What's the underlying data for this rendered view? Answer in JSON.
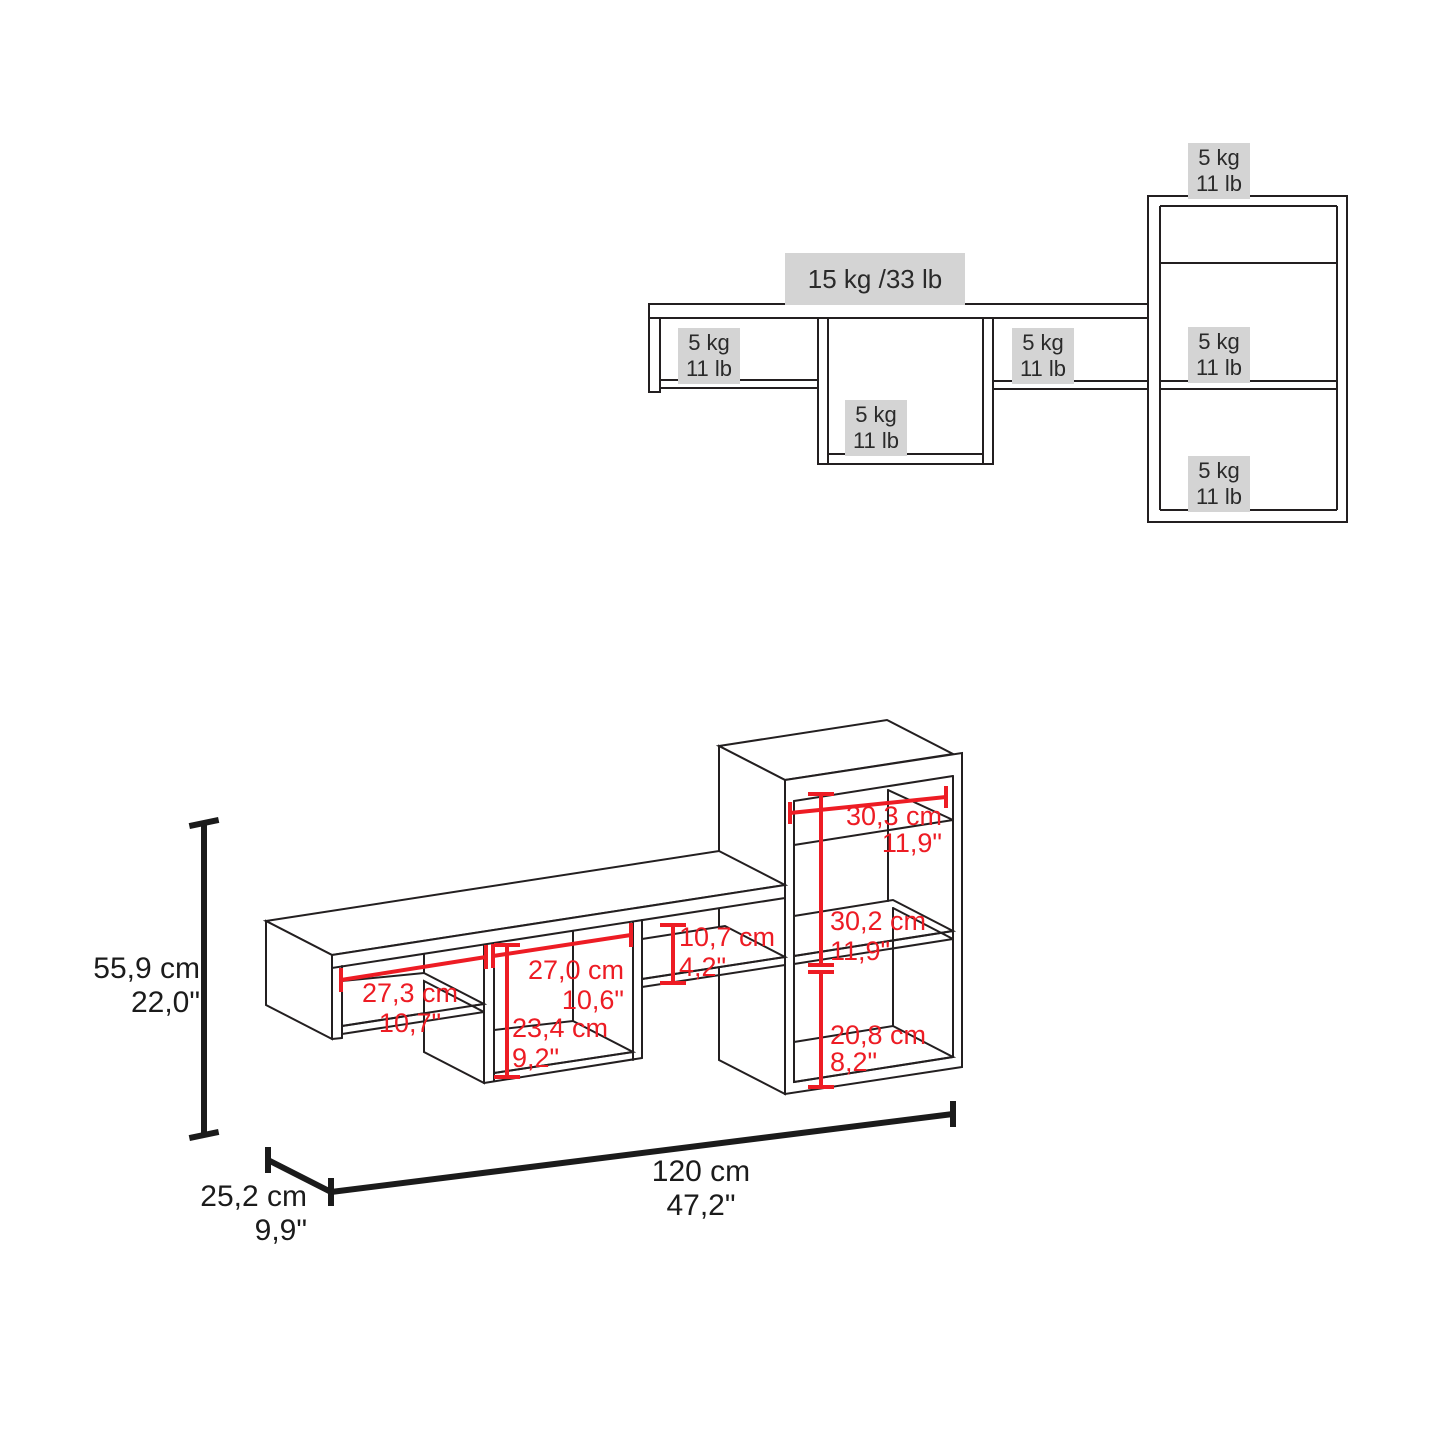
{
  "colors": {
    "line": "#231f20",
    "red": "#ed1c24",
    "black_dim": "#1b1b1b",
    "label_bg": "#d4d4d4"
  },
  "front_view": {
    "main_capacity": "15 kg /33 lb",
    "unit_kg": "5 kg",
    "unit_lb": "11 lb"
  },
  "iso": {
    "height_cm": "55,9 cm",
    "height_in": "22,0\"",
    "depth_cm": "25,2 cm",
    "depth_in": "9,9\"",
    "width_cm": "120 cm",
    "width_in": "47,2\"",
    "left_opening_cm": "27,3 cm",
    "left_opening_in": "10,7\"",
    "center_opening_cm": "27,0 cm",
    "center_opening_in": "10,6\"",
    "center_height_cm": "23,4 cm",
    "center_height_in": "9,2\"",
    "right_height_cm": "10,7 cm",
    "right_height_in": "4,2\"",
    "tower_width_cm": "30,3 cm",
    "tower_width_in": "11,9\"",
    "tower_upper_cm": "30,2 cm",
    "tower_upper_in": "11,9\"",
    "tower_lower_cm": "20,8 cm",
    "tower_lower_in": "8,2\""
  }
}
